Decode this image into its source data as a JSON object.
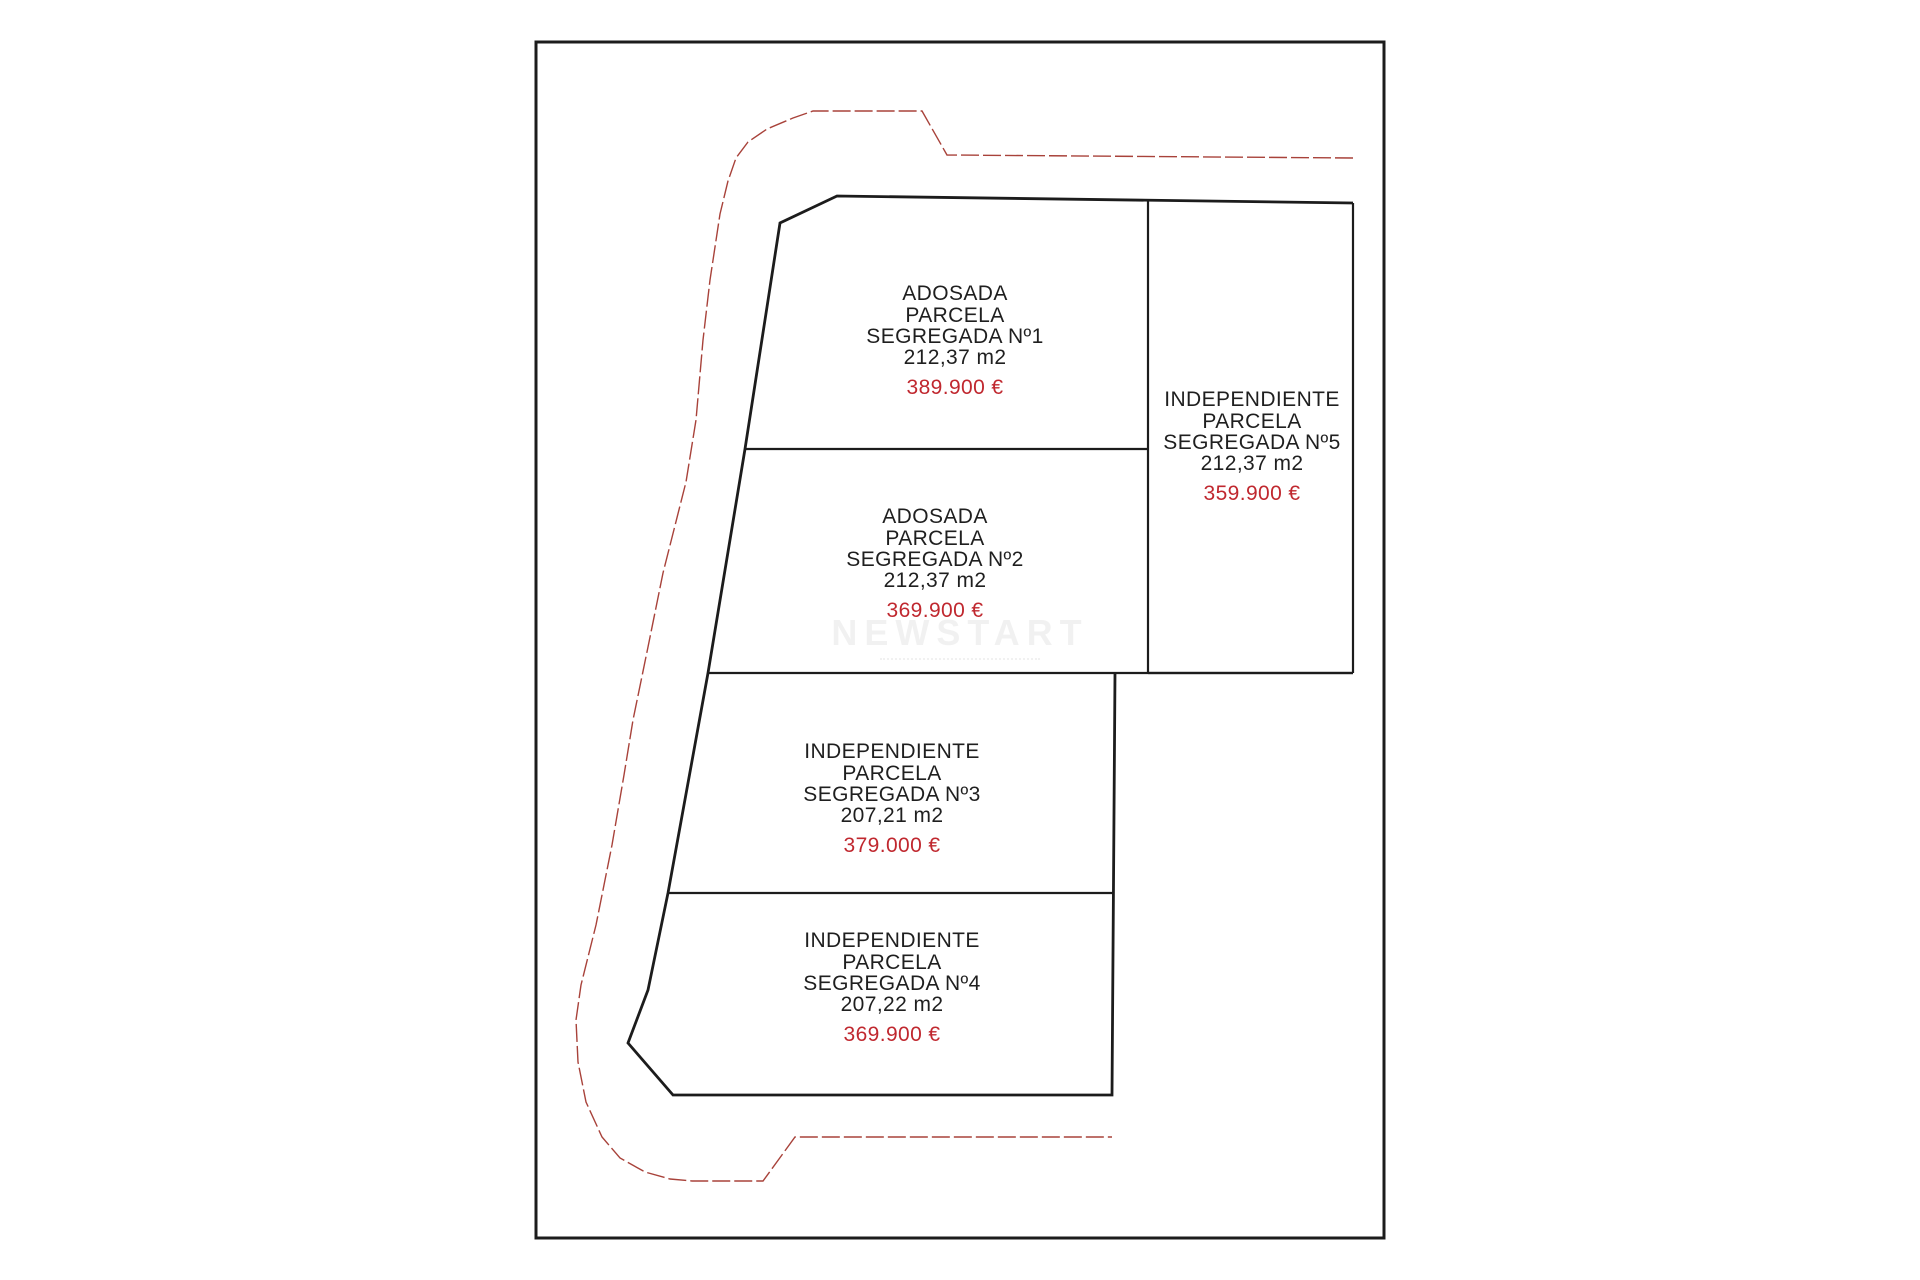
{
  "page": {
    "background": "#ffffff"
  },
  "diagram": {
    "watermark": "NEWSTART",
    "colors": {
      "outline": "#1c1c1c",
      "boundary_red": "#a8423a",
      "price_red": "#c0282f",
      "text": "#1f1f1f"
    },
    "parcels": [
      {
        "id": "1",
        "type": "ADOSADA",
        "label": "PARCELA",
        "number": "SEGREGADA Nº1",
        "area": "212,37 m2",
        "price": "389.900 €"
      },
      {
        "id": "2",
        "type": "ADOSADA",
        "label": "PARCELA",
        "number": "SEGREGADA Nº2",
        "area": "212,37 m2",
        "price": "369.900 €"
      },
      {
        "id": "5",
        "type": "INDEPENDIENTE",
        "label": "PARCELA",
        "number": "SEGREGADA Nº5",
        "area": "212,37 m2",
        "price": "359.900 €"
      },
      {
        "id": "3",
        "type": "INDEPENDIENTE",
        "label": "PARCELA",
        "number": "SEGREGADA Nº3",
        "area": "207,21 m2",
        "price": "379.000 €"
      },
      {
        "id": "4",
        "type": "INDEPENDIENTE",
        "label": "PARCELA",
        "number": "SEGREGADA Nº4",
        "area": "207,22 m2",
        "price": "369.900 €"
      }
    ]
  }
}
